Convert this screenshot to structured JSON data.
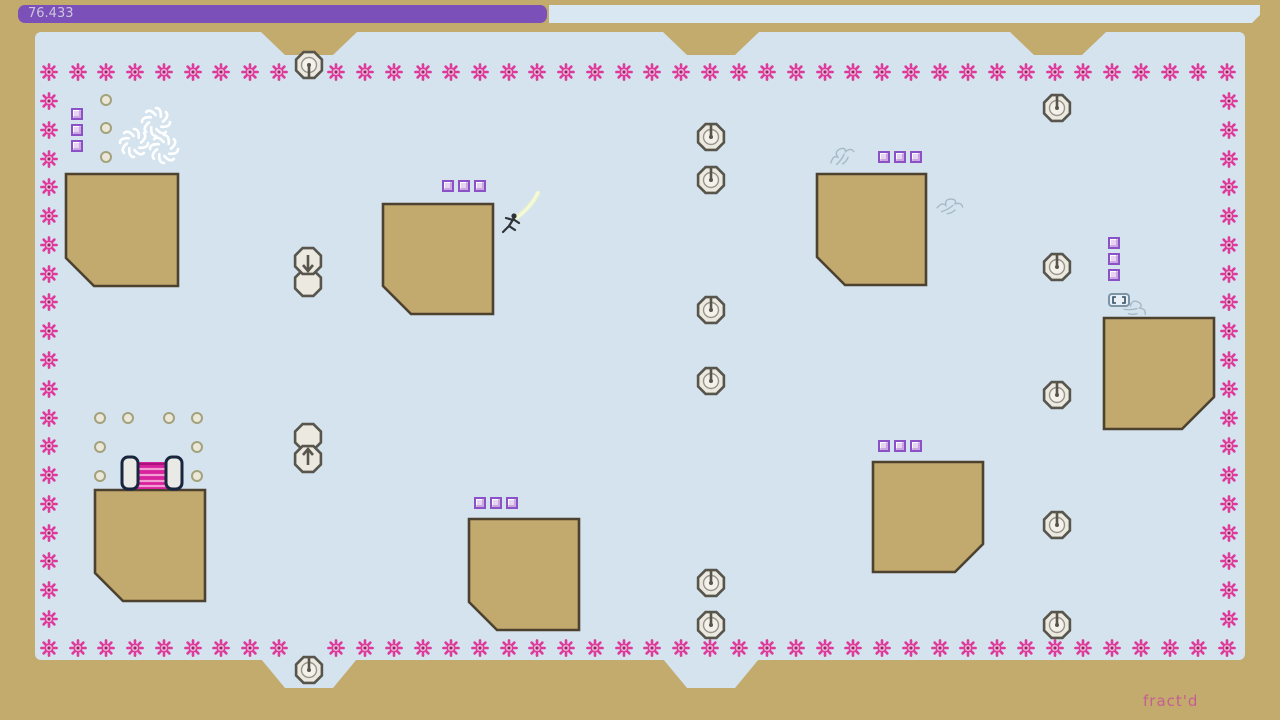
{
  "hud": {
    "timer_text": "76.433"
  },
  "level": {
    "name": "fract'd"
  },
  "colors": {
    "bg_tan": "#c3aa6d",
    "play_blue": "#d4e3ee",
    "block_fill": "#c2a96d",
    "block_outline": "#4d4130",
    "mine_pink": "#dd3a9c",
    "mine_center": "#f0aed4",
    "mine_dot": "#8c2a62",
    "gold_border": "#8b52c8",
    "gold_fill": "#e7d3f2",
    "ring_outline": "#a4a27c",
    "ring_fill": "#ebe7d9",
    "turret_outline": "#57554c",
    "turret_fill": "#ebe9e0",
    "turret_inner": "#f3f1ea",
    "door_outline": "#17263e",
    "door_fill": "#e9e9e5",
    "door_pink": "#d7219d",
    "door_pink_light": "#f29ed2",
    "timer_purple": "#7b50b8",
    "timer_light": "#d9e7f3",
    "timer_text": "#cdc6de",
    "level_name": "#c55f92",
    "ninja_color": "#2e3338",
    "trail_color": "#eef6c6",
    "swirl_color": "#ffffff",
    "scribble_color": "#8fa3b3",
    "ghost_outline": "#7d93a6",
    "ghost_fill": "#e9eff5",
    "ghost_mark": "#2f4f66"
  },
  "entities": {
    "terrain_blocks": [
      {
        "x": 64,
        "y": 172,
        "w": 116,
        "h": 116,
        "cut": "bl",
        "cut_size": 30
      },
      {
        "x": 381,
        "y": 202,
        "w": 114,
        "h": 114,
        "cut": "bl",
        "cut_size": 30
      },
      {
        "x": 815,
        "y": 172,
        "w": 113,
        "h": 115,
        "cut": "bl",
        "cut_size": 30
      },
      {
        "x": 1102,
        "y": 316,
        "w": 114,
        "h": 115,
        "cut": "br",
        "cut_size": 34
      },
      {
        "x": 93,
        "y": 488,
        "w": 114,
        "h": 115,
        "cut": "bl",
        "cut_size": 30
      },
      {
        "x": 467,
        "y": 517,
        "w": 114,
        "h": 115,
        "cut": "bl",
        "cut_size": 30
      },
      {
        "x": 871,
        "y": 460,
        "w": 114,
        "h": 114,
        "cut": "br",
        "cut_size": 30
      }
    ],
    "gauss_turrets": [
      {
        "x": 309,
        "y": 65,
        "dir": "down"
      },
      {
        "x": 711,
        "y": 137,
        "dir": "up"
      },
      {
        "x": 711,
        "y": 180,
        "dir": "up"
      },
      {
        "x": 1057,
        "y": 108,
        "dir": "up"
      },
      {
        "x": 1057,
        "y": 267,
        "dir": "up"
      },
      {
        "x": 711,
        "y": 310,
        "dir": "up"
      },
      {
        "x": 711,
        "y": 381,
        "dir": "up"
      },
      {
        "x": 1057,
        "y": 395,
        "dir": "up"
      },
      {
        "x": 1057,
        "y": 525,
        "dir": "up"
      },
      {
        "x": 711,
        "y": 583,
        "dir": "up"
      },
      {
        "x": 711,
        "y": 625,
        "dir": "up"
      },
      {
        "x": 1057,
        "y": 625,
        "dir": "up"
      },
      {
        "x": 309,
        "y": 670,
        "dir": "up"
      }
    ],
    "launch_pads": [
      {
        "x": 308,
        "y": 272,
        "dir": "down"
      },
      {
        "x": 308,
        "y": 448,
        "dir": "up"
      }
    ],
    "gold_groups": [
      {
        "x": 448,
        "y": 186,
        "dir": "h"
      },
      {
        "x": 884,
        "y": 157,
        "dir": "h"
      },
      {
        "x": 480,
        "y": 503,
        "dir": "h"
      },
      {
        "x": 884,
        "y": 446,
        "dir": "h"
      },
      {
        "x": 77,
        "y": 114,
        "dir": "v"
      },
      {
        "x": 1114,
        "y": 243,
        "dir": "v"
      }
    ],
    "gold_spacing": 16,
    "toggle_mines": [
      [
        106,
        100
      ],
      [
        106,
        128
      ],
      [
        106,
        157
      ],
      [
        100,
        418
      ],
      [
        128,
        418
      ],
      [
        169,
        418
      ],
      [
        197,
        418
      ],
      [
        100,
        447
      ],
      [
        197,
        447
      ],
      [
        100,
        476
      ],
      [
        197,
        476
      ]
    ],
    "border_mines": {
      "top": {
        "y": 72,
        "x_start": 49,
        "x_end": 1227,
        "count": 42,
        "skip_x": [
          308
        ]
      },
      "bottom": {
        "y": 648,
        "x_start": 49,
        "x_end": 1227,
        "count": 42,
        "skip_x": [
          308
        ]
      },
      "left": {
        "x": 49,
        "y_start": 101,
        "y_end": 619,
        "count": 19
      },
      "right": {
        "x": 1229,
        "y_start": 101,
        "y_end": 619,
        "count": 19
      }
    },
    "notches": {
      "top_centers": [
        309,
        711,
        1058
      ],
      "bottom_centers": [
        309,
        711
      ]
    },
    "exit_door": {
      "x": 120,
      "y": 454
    },
    "ninja": {
      "x": 513,
      "y": 222
    },
    "swirl_drones": [
      [
        156,
        122
      ],
      [
        134,
        143
      ],
      [
        164,
        149
      ]
    ],
    "scribbles": [
      [
        840,
        153
      ],
      [
        949,
        203
      ],
      [
        1134,
        305
      ]
    ],
    "ghost_drone": {
      "x": 1108,
      "y": 293
    }
  }
}
